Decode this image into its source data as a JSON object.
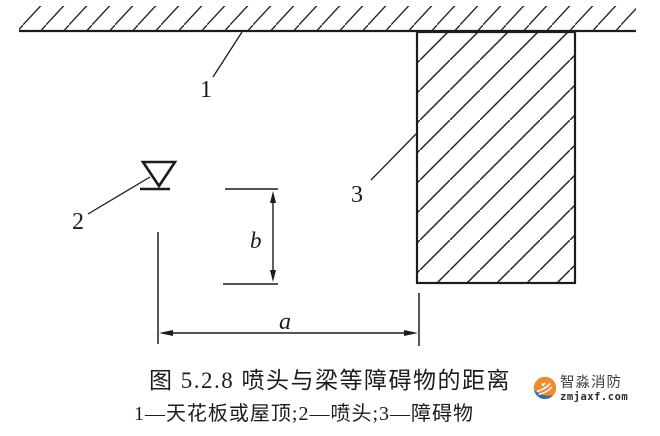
{
  "diagram": {
    "labels": {
      "ceiling_ref": "1",
      "sprinkler_ref": "2",
      "obstruction_ref": "3",
      "dim_horizontal": "a",
      "dim_vertical": "b"
    }
  },
  "caption": {
    "title": "图 5.2.8  喷头与梁等障碍物的距离",
    "legend": "1—天花板或屋顶;2—喷头;3—障碍物"
  },
  "watermark": {
    "brand": "智淼消防",
    "domain": "zmjaxf.com"
  },
  "colors": {
    "line": "#1c1c1c",
    "background": "#ffffff",
    "logo_orange": "#f28a2a",
    "logo_blue": "#2a6fb5",
    "logo_text": "#3f3f3f"
  }
}
